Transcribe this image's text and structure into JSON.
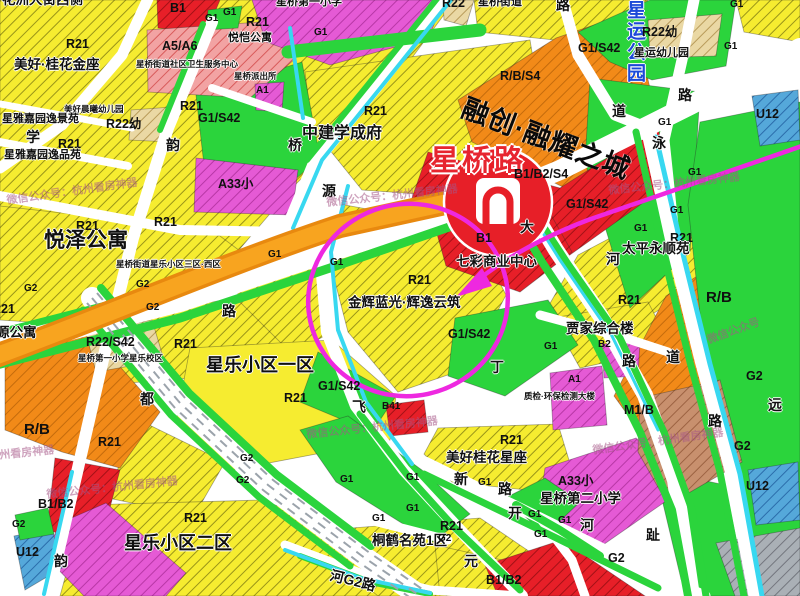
{
  "map": {
    "title_area": "星桥路片区用地现状图（截图）",
    "metro": {
      "station_name": "星桥路",
      "line_color": "#f8a41f",
      "logo_color": "#e71f28"
    },
    "annotation": {
      "shape": "hand-drawn circle with arrow",
      "color": "#ee28e0",
      "target": "金辉蓝光·辉逸云筑 R21 地块"
    },
    "watermark_text": "微信公众号：杭州看房神器",
    "zone_palette": {
      "residential_R21": "#f6ec30",
      "green_G1_G2": "#2bd43c",
      "commercial_B": "#e71f28",
      "mixed_RB": "#f28a18",
      "school_A33": "#e55ad5",
      "clinic_A5A6": "#f2a3a3",
      "kindergarten_R22": "#ead8a4",
      "industry_M1B": "#c8906e",
      "utility_U12": "#55a8da",
      "water": "#38d8f0"
    },
    "labels": [
      {
        "t": "花洲大街西侧",
        "x": 2,
        "y": -7,
        "c": "n-l"
      },
      {
        "t": "R21",
        "x": 66,
        "y": 38,
        "c": "z"
      },
      {
        "t": "美好·桂花金座",
        "x": 14,
        "y": 58,
        "c": "n-l"
      },
      {
        "t": "B1",
        "x": 170,
        "y": 2,
        "c": "z"
      },
      {
        "t": "G1",
        "x": 205,
        "y": 14,
        "c": "z-s"
      },
      {
        "t": "G1",
        "x": 223,
        "y": 8,
        "c": "z-s"
      },
      {
        "t": "R21",
        "x": 246,
        "y": 16,
        "c": "z"
      },
      {
        "t": "悦恺公寓",
        "x": 228,
        "y": 33,
        "c": "n"
      },
      {
        "t": "A5/A6",
        "x": 162,
        "y": 40,
        "c": "z"
      },
      {
        "t": "星桥街道社区卫生服务中心",
        "x": 136,
        "y": 60,
        "c": "n-xs"
      },
      {
        "t": "星桥派出所",
        "x": 234,
        "y": 72,
        "c": "n-xs"
      },
      {
        "t": "A1",
        "x": 256,
        "y": 86,
        "c": "z-s"
      },
      {
        "t": "美好晨曦幼儿园",
        "x": 64,
        "y": 105,
        "c": "n-xs"
      },
      {
        "t": "R22幼",
        "x": 106,
        "y": 118,
        "c": "z"
      },
      {
        "t": "G1/S42",
        "x": 198,
        "y": 112,
        "c": "z"
      },
      {
        "t": "韵",
        "x": 166,
        "y": 138,
        "c": "rd"
      },
      {
        "t": "A33小",
        "x": 218,
        "y": 178,
        "c": "z"
      },
      {
        "t": "星雅嘉园逸景苑",
        "x": 2,
        "y": 114,
        "c": "n"
      },
      {
        "t": "学",
        "x": 26,
        "y": 130,
        "c": "rd"
      },
      {
        "t": "R21",
        "x": 58,
        "y": 138,
        "c": "z"
      },
      {
        "t": "星雅嘉园逸品苑",
        "x": 4,
        "y": 150,
        "c": "n"
      },
      {
        "t": "R21",
        "x": 180,
        "y": 100,
        "c": "z"
      },
      {
        "t": "星桥第一小学",
        "x": 276,
        "y": -3,
        "c": "n"
      },
      {
        "t": "R22",
        "x": 442,
        "y": -3,
        "c": "z"
      },
      {
        "t": "星桥街道",
        "x": 478,
        "y": -3,
        "c": "n"
      },
      {
        "t": "G1",
        "x": 314,
        "y": 28,
        "c": "z-s"
      },
      {
        "t": "R21",
        "x": 364,
        "y": 105,
        "c": "z"
      },
      {
        "t": "中建学成府",
        "x": 302,
        "y": 126,
        "c": "n-xl"
      },
      {
        "t": "桥",
        "x": 288,
        "y": 138,
        "c": "rd"
      },
      {
        "t": "源",
        "x": 322,
        "y": 184,
        "c": "rd"
      },
      {
        "t": "R/B/S4",
        "x": 500,
        "y": 70,
        "c": "z"
      },
      {
        "t": "融创·融耀之城",
        "x": 468,
        "y": 94,
        "c": "n-rc",
        "r": 21
      },
      {
        "t": "星桥路",
        "x": 430,
        "y": 146,
        "c": "st"
      },
      {
        "t": "B1/B2/S4",
        "x": 514,
        "y": 168,
        "c": "z"
      },
      {
        "t": "G1/S42",
        "x": 566,
        "y": 198,
        "c": "z"
      },
      {
        "t": "大",
        "x": 520,
        "y": 220,
        "c": "rd"
      },
      {
        "t": "道",
        "x": 612,
        "y": 104,
        "c": "rd"
      },
      {
        "t": "泳",
        "x": 652,
        "y": 136,
        "c": "rd"
      },
      {
        "t": "路",
        "x": 556,
        "y": -2,
        "c": "rd"
      },
      {
        "t": "星运公园",
        "x": 624,
        "y": 0,
        "c": "pk"
      },
      {
        "t": "G1/S42",
        "x": 578,
        "y": 42,
        "c": "z"
      },
      {
        "t": "R22幼",
        "x": 642,
        "y": 26,
        "c": "z"
      },
      {
        "t": "星运幼儿园",
        "x": 634,
        "y": 48,
        "c": "n"
      },
      {
        "t": "G1",
        "x": 724,
        "y": 42,
        "c": "z-s"
      },
      {
        "t": "G1",
        "x": 730,
        "y": 0,
        "c": "z-s"
      },
      {
        "t": "路",
        "x": 678,
        "y": 88,
        "c": "rd"
      },
      {
        "t": "U12",
        "x": 756,
        "y": 108,
        "c": "z"
      },
      {
        "t": "G1",
        "x": 658,
        "y": 118,
        "c": "z-s"
      },
      {
        "t": "G1",
        "x": 688,
        "y": 168,
        "c": "z-s"
      },
      {
        "t": "G1",
        "x": 670,
        "y": 206,
        "c": "z-s"
      },
      {
        "t": "G1",
        "x": 634,
        "y": 224,
        "c": "z-s"
      },
      {
        "t": "R21",
        "x": 670,
        "y": 232,
        "c": "z"
      },
      {
        "t": "河",
        "x": 606,
        "y": 252,
        "c": "rd"
      },
      {
        "t": "太平永顺苑",
        "x": 622,
        "y": 242,
        "c": "n-l"
      },
      {
        "t": "R21",
        "x": 618,
        "y": 294,
        "c": "z"
      },
      {
        "t": "B1",
        "x": 476,
        "y": 232,
        "c": "z"
      },
      {
        "t": "七彩商业中心",
        "x": 456,
        "y": 255,
        "c": "n-l"
      },
      {
        "t": "R21",
        "x": 408,
        "y": 274,
        "c": "z"
      },
      {
        "t": "金辉蓝光·辉逸云筑",
        "x": 348,
        "y": 296,
        "c": "n-l"
      },
      {
        "t": "G1/S42",
        "x": 448,
        "y": 328,
        "c": "z"
      },
      {
        "t": "G1/S42",
        "x": 318,
        "y": 380,
        "c": "z"
      },
      {
        "t": "丁",
        "x": 490,
        "y": 360,
        "c": "rd"
      },
      {
        "t": "贾家综合楼",
        "x": 566,
        "y": 322,
        "c": "n-l"
      },
      {
        "t": "G1",
        "x": 544,
        "y": 342,
        "c": "z-s"
      },
      {
        "t": "B2",
        "x": 598,
        "y": 340,
        "c": "z-s"
      },
      {
        "t": "路",
        "x": 622,
        "y": 354,
        "c": "rd"
      },
      {
        "t": "道",
        "x": 666,
        "y": 350,
        "c": "rd"
      },
      {
        "t": "A1",
        "x": 568,
        "y": 375,
        "c": "z-s"
      },
      {
        "t": "质检·环保检测大楼",
        "x": 524,
        "y": 392,
        "c": "n-xs"
      },
      {
        "t": "M1/B",
        "x": 624,
        "y": 404,
        "c": "z"
      },
      {
        "t": "R/B",
        "x": 706,
        "y": 290,
        "c": "z-l"
      },
      {
        "t": "G2",
        "x": 746,
        "y": 370,
        "c": "z"
      },
      {
        "t": "远",
        "x": 768,
        "y": 398,
        "c": "rd"
      },
      {
        "t": "路",
        "x": 708,
        "y": 414,
        "c": "rd"
      },
      {
        "t": "G2",
        "x": 734,
        "y": 440,
        "c": "z"
      },
      {
        "t": "U12",
        "x": 746,
        "y": 480,
        "c": "z"
      },
      {
        "t": "G2",
        "x": 608,
        "y": 552,
        "c": "z"
      },
      {
        "t": "趾",
        "x": 646,
        "y": 528,
        "c": "rd"
      },
      {
        "t": "R21",
        "x": 76,
        "y": 220,
        "c": "z"
      },
      {
        "t": "R21",
        "x": 154,
        "y": 216,
        "c": "z"
      },
      {
        "t": "悦泽公寓",
        "x": 44,
        "y": 230,
        "c": "n-xxl"
      },
      {
        "t": "星桥街道星乐小区三区·西区",
        "x": 116,
        "y": 260,
        "c": "n-xs"
      },
      {
        "t": "G2",
        "x": 24,
        "y": 284,
        "c": "z-s"
      },
      {
        "t": "G2",
        "x": 136,
        "y": 280,
        "c": "z-s"
      },
      {
        "t": "G2",
        "x": 146,
        "y": 303,
        "c": "z-s"
      },
      {
        "t": "R21",
        "x": -8,
        "y": 303,
        "c": "z"
      },
      {
        "t": "源公寓",
        "x": -4,
        "y": 326,
        "c": "n-l"
      },
      {
        "t": "路",
        "x": 222,
        "y": 304,
        "c": "rd"
      },
      {
        "t": "R22/S42",
        "x": 86,
        "y": 336,
        "c": "z"
      },
      {
        "t": "R21",
        "x": 174,
        "y": 338,
        "c": "z"
      },
      {
        "t": "星桥第一小学星乐校区",
        "x": 78,
        "y": 354,
        "c": "n-xs"
      },
      {
        "t": "G1",
        "x": 268,
        "y": 250,
        "c": "z-s"
      },
      {
        "t": "G1",
        "x": 330,
        "y": 258,
        "c": "z-s"
      },
      {
        "t": "星乐小区一区",
        "x": 206,
        "y": 356,
        "c": "n-xx"
      },
      {
        "t": "R21",
        "x": 284,
        "y": 392,
        "c": "z"
      },
      {
        "t": "都",
        "x": 140,
        "y": 392,
        "c": "rd"
      },
      {
        "t": "R/B",
        "x": 24,
        "y": 422,
        "c": "z-l"
      },
      {
        "t": "R21",
        "x": 98,
        "y": 436,
        "c": "z"
      },
      {
        "t": "B1/B2",
        "x": 38,
        "y": 498,
        "c": "z"
      },
      {
        "t": "G2",
        "x": 12,
        "y": 520,
        "c": "z-s"
      },
      {
        "t": "U12",
        "x": 16,
        "y": 546,
        "c": "z"
      },
      {
        "t": "韵",
        "x": 54,
        "y": 554,
        "c": "rd"
      },
      {
        "t": "R21",
        "x": 184,
        "y": 512,
        "c": "z"
      },
      {
        "t": "星乐小区二区",
        "x": 124,
        "y": 534,
        "c": "n-xx"
      },
      {
        "t": "G2",
        "x": 240,
        "y": 454,
        "c": "z-s"
      },
      {
        "t": "G2",
        "x": 236,
        "y": 476,
        "c": "z-s"
      },
      {
        "t": "飞",
        "x": 352,
        "y": 400,
        "c": "rd"
      },
      {
        "t": "B41",
        "x": 382,
        "y": 402,
        "c": "z-s"
      },
      {
        "t": "R21",
        "x": 440,
        "y": 520,
        "c": "z"
      },
      {
        "t": "桐鹤名苑1区",
        "x": 372,
        "y": 534,
        "c": "n-l"
      },
      {
        "t": "G2",
        "x": 438,
        "y": 534,
        "c": "z-s"
      },
      {
        "t": "河G2路",
        "x": 332,
        "y": 568,
        "c": "rd",
        "r": 14
      },
      {
        "t": "元",
        "x": 464,
        "y": 554,
        "c": "rd"
      },
      {
        "t": "B1/B2",
        "x": 486,
        "y": 574,
        "c": "z"
      },
      {
        "t": "R21",
        "x": 500,
        "y": 434,
        "c": "z"
      },
      {
        "t": "美好桂花星座",
        "x": 446,
        "y": 451,
        "c": "n-l"
      },
      {
        "t": "新",
        "x": 454,
        "y": 472,
        "c": "rd"
      },
      {
        "t": "G1",
        "x": 478,
        "y": 478,
        "c": "z-s"
      },
      {
        "t": "路",
        "x": 498,
        "y": 482,
        "c": "rd"
      },
      {
        "t": "G1",
        "x": 406,
        "y": 473,
        "c": "z-s"
      },
      {
        "t": "G1",
        "x": 340,
        "y": 475,
        "c": "z-s"
      },
      {
        "t": "G1",
        "x": 372,
        "y": 514,
        "c": "z-s"
      },
      {
        "t": "G1",
        "x": 406,
        "y": 504,
        "c": "z-s"
      },
      {
        "t": "开",
        "x": 508,
        "y": 506,
        "c": "rd"
      },
      {
        "t": "G1",
        "x": 528,
        "y": 510,
        "c": "z-s"
      },
      {
        "t": "G1",
        "x": 534,
        "y": 530,
        "c": "z-s"
      },
      {
        "t": "G1",
        "x": 558,
        "y": 516,
        "c": "z-s"
      },
      {
        "t": "河",
        "x": 580,
        "y": 518,
        "c": "rd"
      },
      {
        "t": "A33小",
        "x": 558,
        "y": 475,
        "c": "z"
      },
      {
        "t": "星桥第二小学",
        "x": 540,
        "y": 492,
        "c": "n-l"
      },
      {
        "t": "微信公众号：杭州看房神器",
        "x": 6,
        "y": 196,
        "c": "wm",
        "r": -8
      },
      {
        "t": "微信公众号：杭州看房神器",
        "x": 326,
        "y": 198,
        "c": "wm",
        "r": -6
      },
      {
        "t": "微信公众号：杭州看房神器",
        "x": 306,
        "y": 430,
        "c": "wm",
        "r": -6
      },
      {
        "t": "微信公众号：杭州看房神器",
        "x": 46,
        "y": 490,
        "c": "wm",
        "r": -6
      },
      {
        "t": "微信公众号：杭州看房神器",
        "x": 592,
        "y": 446,
        "c": "wm",
        "r": -8
      },
      {
        "t": "微信公众号：杭州看房神器",
        "x": 608,
        "y": 186,
        "c": "wm",
        "r": -6
      },
      {
        "t": "微信公众号",
        "x": 706,
        "y": 336,
        "c": "wm",
        "r": -20
      },
      {
        "t": "杭州看房神器",
        "x": -12,
        "y": 452,
        "c": "wm",
        "r": -6
      }
    ]
  }
}
